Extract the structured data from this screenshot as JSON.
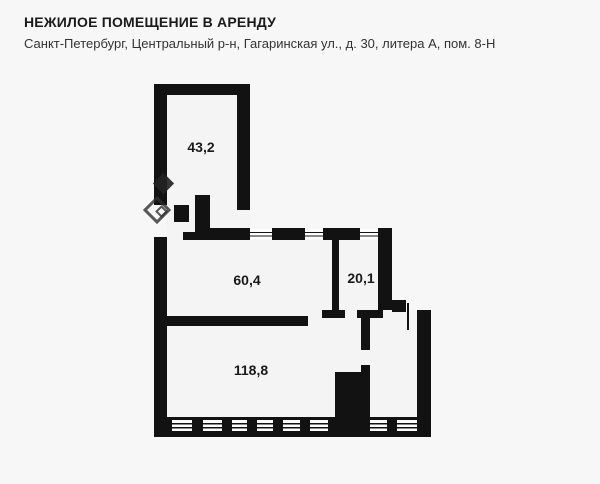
{
  "header": {
    "title": "НЕЖИЛОЕ ПОМЕЩЕНИЕ В АРЕНДУ",
    "subtitle": "Санкт-Петербург, Центральный р-н, Гагаринская ул., д. 30, литера А, пом. 8-Н"
  },
  "floor_plan": {
    "rooms": [
      {
        "name": "room-top",
        "area_label": "43,2"
      },
      {
        "name": "room-middle-left",
        "area_label": "60,4"
      },
      {
        "name": "room-middle-right",
        "area_label": "20,1"
      },
      {
        "name": "room-bottom",
        "area_label": "118,8"
      }
    ],
    "colors": {
      "wall": "#121212",
      "floor": "#f4f4f5",
      "background": "#f7f7f8",
      "text": "#1a1a1a"
    },
    "watermark": "cian-logo"
  }
}
